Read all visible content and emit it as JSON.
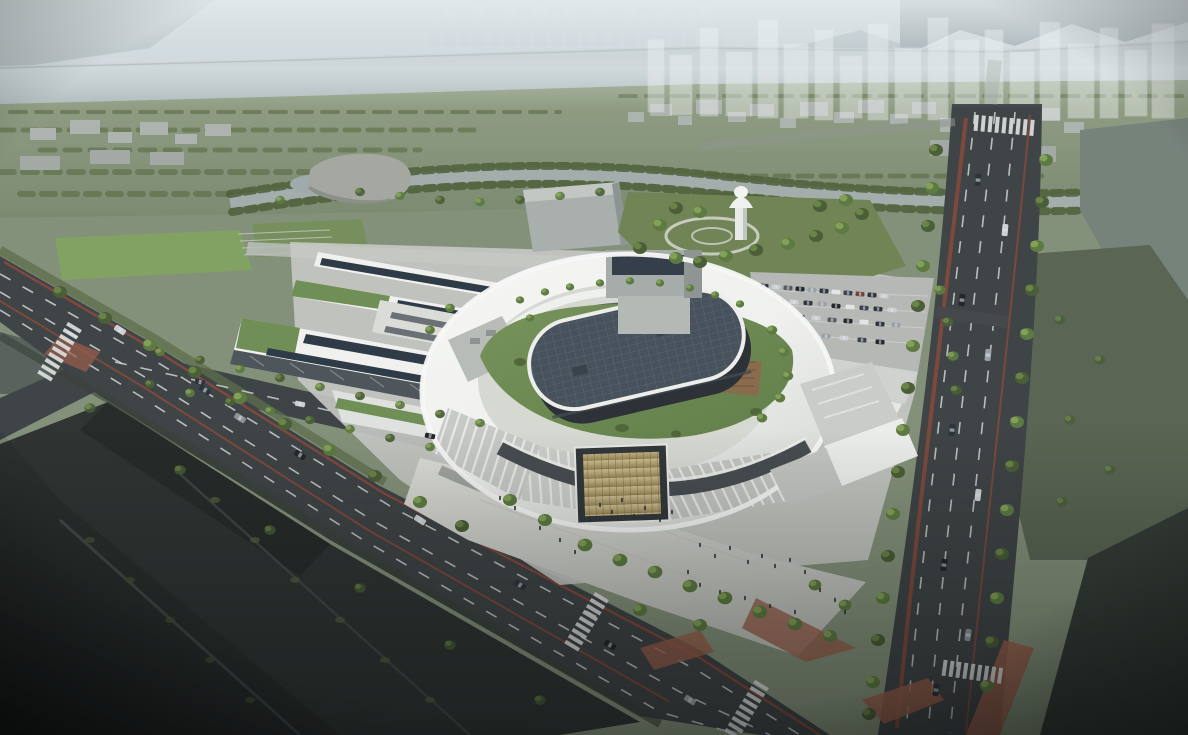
{
  "scene": {
    "type": "architectural-aerial-rendering",
    "view": "aerial-oblique",
    "time_of_day": "day-hazy",
    "subject": "circular-campus-building-with-green-roof"
  },
  "palette": {
    "ground": "#84917a",
    "sky_top": "#aebcc5",
    "sky_bottom": "#d6dcde",
    "mountain": "#75848a",
    "river": "#c3cdd0",
    "river_edge": "#97a3a5",
    "farland": "#93a086",
    "farland_deep": "#7c8a72",
    "tree_dark": "#4a5e38",
    "tree_light": "#6a8347",
    "block_gray": "#adb3ae",
    "ghost_tower": "#f2f5f6",
    "canal": "#a3aeac",
    "water_mid": "#76837b",
    "water_dark": "#353c37",
    "field_green": "#5a6553",
    "road": "#3f4446",
    "lane": "#cfd3d4",
    "bike_red": "#8a4a3c",
    "brick": "#9a604c",
    "plaza": "#d2d3cd",
    "ring_white": "#f0f1ef",
    "ring_shade": "#d7dad6",
    "roof_gray": "#c6c9c5",
    "rib_white": "#e8eae6",
    "panel_dark": "#353f49",
    "lawn": "#76935a",
    "lawn_deep": "#637f4b",
    "oval_roof": "#47525c",
    "oval_wall": "#2c3238",
    "gold_gate": "#c4b185",
    "solar": "#2f3b47",
    "lattice": "#4e555b",
    "lot": "#b5b8b5",
    "car_dark": "#2e343c",
    "car_light": "#ccd0d2",
    "field_dark": "#2b302f",
    "vignette": "#0a0e0e"
  }
}
